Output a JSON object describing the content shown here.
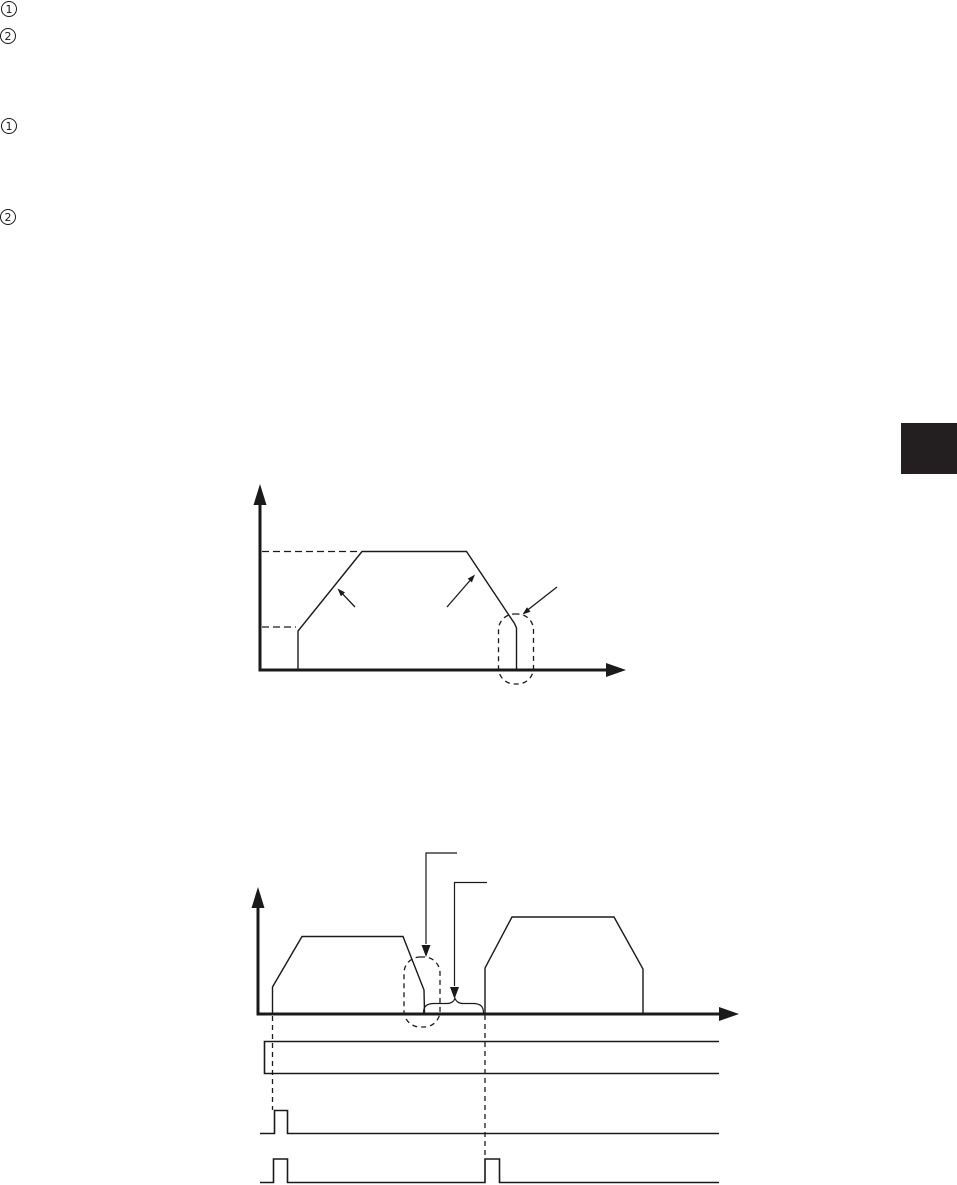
{
  "page": {
    "kind": "technical-manual-page",
    "background": "#ffffff",
    "ink_color": "#1a1a1a",
    "side_tab_color": "#231f20"
  },
  "circled_markers": [
    {
      "label": "1"
    },
    {
      "label": "2"
    },
    {
      "label": "1"
    },
    {
      "label": "2"
    }
  ],
  "figures": [
    {
      "name": "trapezoidal-speed-profile",
      "type": "line-diagram",
      "description": "Speed-versus-time trapezoid: initial step to start speed, acceleration ramp marked by an arrow, constant speed at a dashed maximum-speed level, deceleration ramp marked by an arrow, and a final vertical stop drop enclosed in a dashed capsule with a leader arrow.",
      "axis_labels": {
        "x": "",
        "y": ""
      },
      "dashed_levels": [
        "maximum-speed-level",
        "start-speed-level"
      ]
    },
    {
      "name": "two-operation-timing",
      "type": "line-diagram",
      "description": "Two trapezoidal moves separated by a pause; dashed capsule around the first deceleration stop with a down-arrow callout; an upward curly brace with a down-arrow callout marks the pause; dashed guide lines drop to three timing traces: a level band signal, a single start pulse, and two start pulses.",
      "axis_labels": {
        "x": "",
        "y": ""
      },
      "signals": [
        {
          "name": "level-band-signal",
          "pulses": 0
        },
        {
          "name": "single-pulse-signal",
          "pulses": 1
        },
        {
          "name": "double-pulse-signal",
          "pulses": 2
        }
      ]
    }
  ]
}
